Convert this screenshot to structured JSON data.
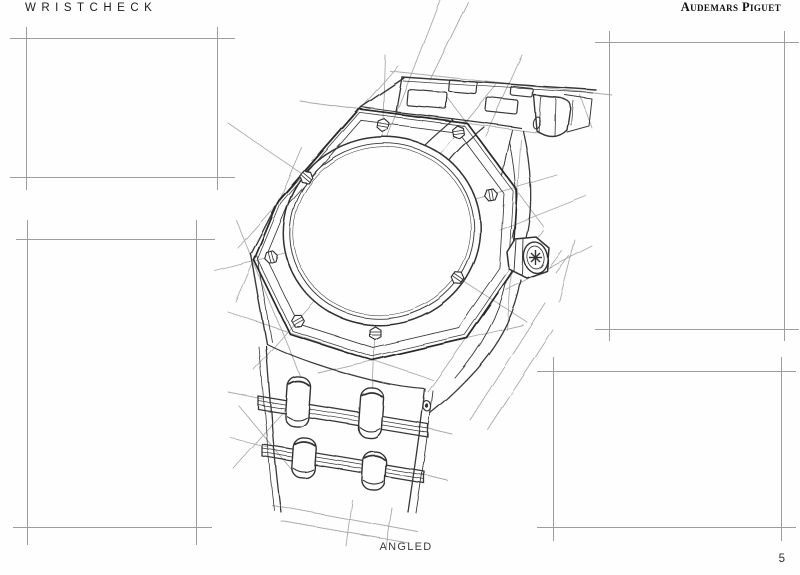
{
  "header": {
    "brand_left": "WRISTCHECK",
    "brand_right": "Audemars Piguet"
  },
  "footer": {
    "caption": "ANGLED",
    "page_number": "5"
  },
  "sketch": {
    "subject": "Hand pencil sketch of an Audemars Piguet Royal Oak wristwatch, angled three-quarter view",
    "view_label": "ANGLED",
    "features": {
      "bezel": "octagonal bezel with 8 hexagonal screws",
      "dial": "blank round dial",
      "crown": "hexagonal crown with star motif on right side",
      "bracelet": "integrated link bracelet at top-right and bottom-left",
      "guides": "light construction guide lines extending from edges and screws"
    },
    "screw_count": 8,
    "empty_frames": 4
  },
  "colors": {
    "paper": "#fefefe",
    "ink": "#333333",
    "ink_dark": "#2b2b2b",
    "guide_line": "#9b9b9b",
    "frame_line": "#8d8d8d",
    "text": "#1c1c1c"
  }
}
